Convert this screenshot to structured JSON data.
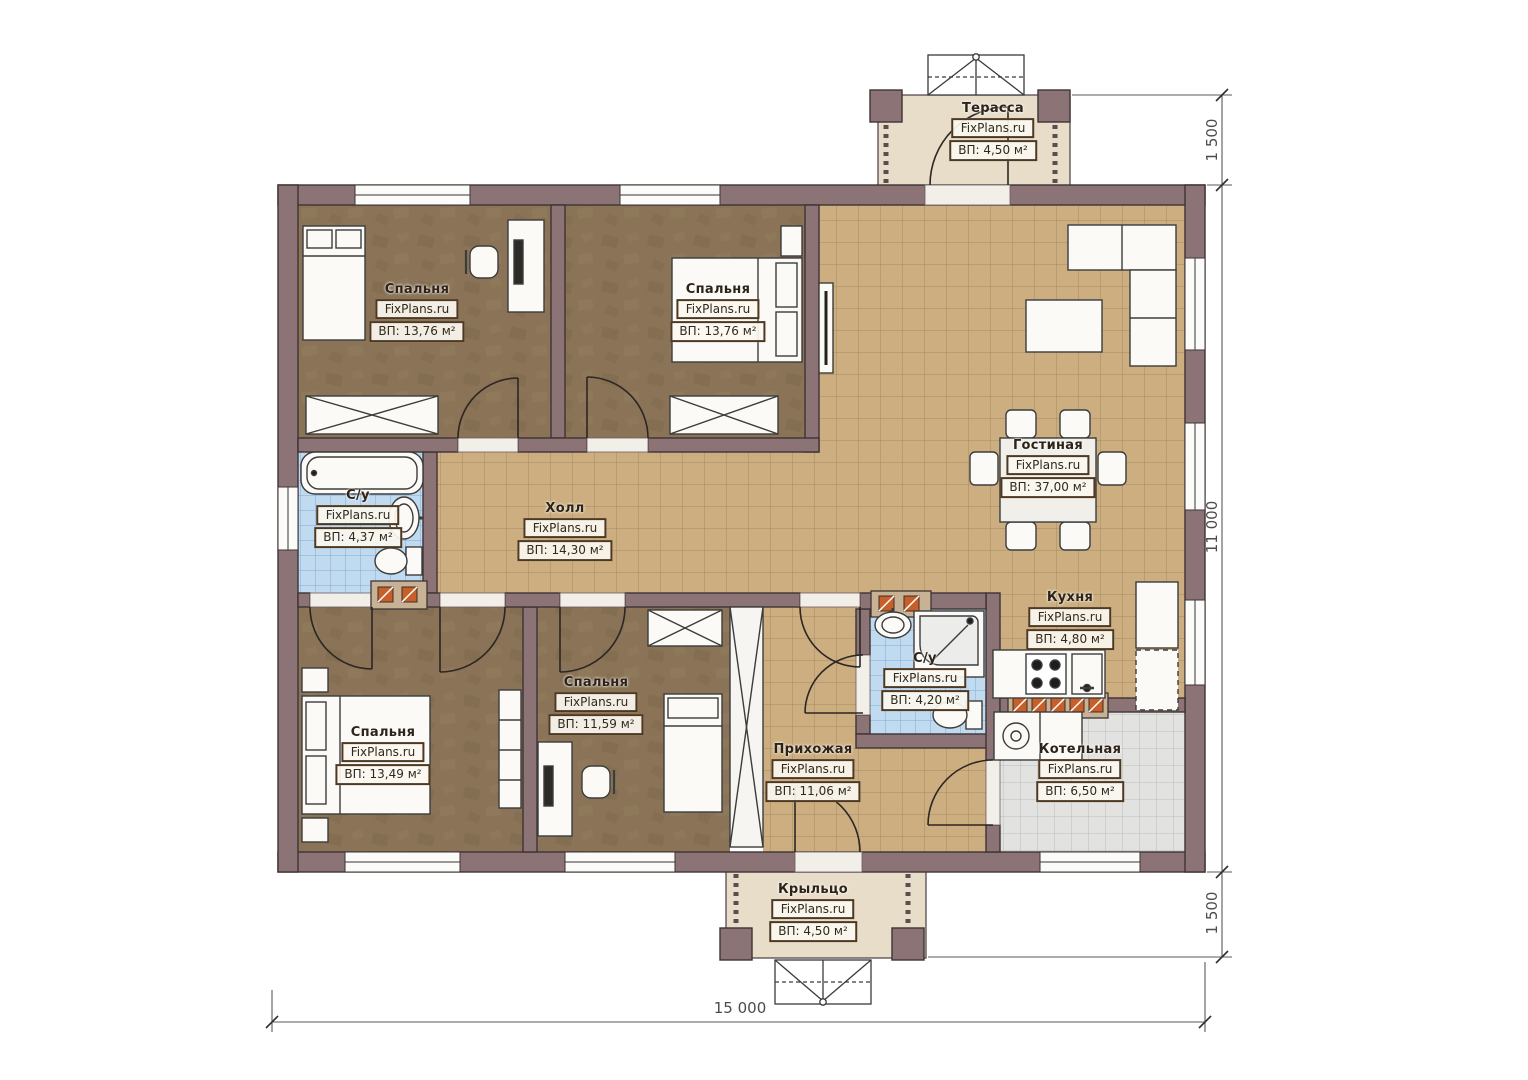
{
  "brand": "FixPlans.ru",
  "rooms": {
    "terrace": {
      "name": "Терасса",
      "brand": "FixPlans.ru",
      "area": "ВП: 4,50 м²"
    },
    "bedroom_top_left": {
      "name": "Спальня",
      "brand": "FixPlans.ru",
      "area": "ВП: 13,76 м²"
    },
    "bedroom_top_middle": {
      "name": "Спальня",
      "brand": "FixPlans.ru",
      "area": "ВП: 13,76 м²"
    },
    "bathroom_left": {
      "name": "С/у",
      "brand": "FixPlans.ru",
      "area": "ВП: 4,37 м²"
    },
    "hall": {
      "name": "Холл",
      "brand": "FixPlans.ru",
      "area": "ВП: 14,30 м²"
    },
    "living_room": {
      "name": "Гостиная",
      "brand": "FixPlans.ru",
      "area": "ВП: 37,00 м²"
    },
    "kitchen": {
      "name": "Кухня",
      "brand": "FixPlans.ru",
      "area": "ВП: 4,80 м²"
    },
    "bathroom_right": {
      "name": "С/у",
      "brand": "FixPlans.ru",
      "area": "ВП: 4,20 м²"
    },
    "bedroom_bottom_left": {
      "name": "Спальня",
      "brand": "FixPlans.ru",
      "area": "ВП: 13,49 м²"
    },
    "bedroom_bottom_middle": {
      "name": "Спальня",
      "brand": "FixPlans.ru",
      "area": "ВП: 11,59 м²"
    },
    "entry_hall": {
      "name": "Прихожая",
      "brand": "FixPlans.ru",
      "area": "ВП: 11,06 м²"
    },
    "boiler_room": {
      "name": "Котельная",
      "brand": "FixPlans.ru",
      "area": "ВП: 6,50 м²"
    },
    "porch": {
      "name": "Крыльцо",
      "brand": "FixPlans.ru",
      "area": "ВП: 4,50 м²"
    }
  },
  "dimensions": {
    "terrace_depth": "1 500",
    "house_depth": "11 000",
    "porch_depth": "1 500",
    "house_width": "15 000"
  },
  "colors": {
    "wall": "#8c7376",
    "tile_tan": "#ccae80",
    "tile_blue": "#c0daef",
    "tile_gray": "#e2e2e1",
    "bedroom_floor": "#8a7356",
    "terrace_floor": "#e7ddc9"
  }
}
